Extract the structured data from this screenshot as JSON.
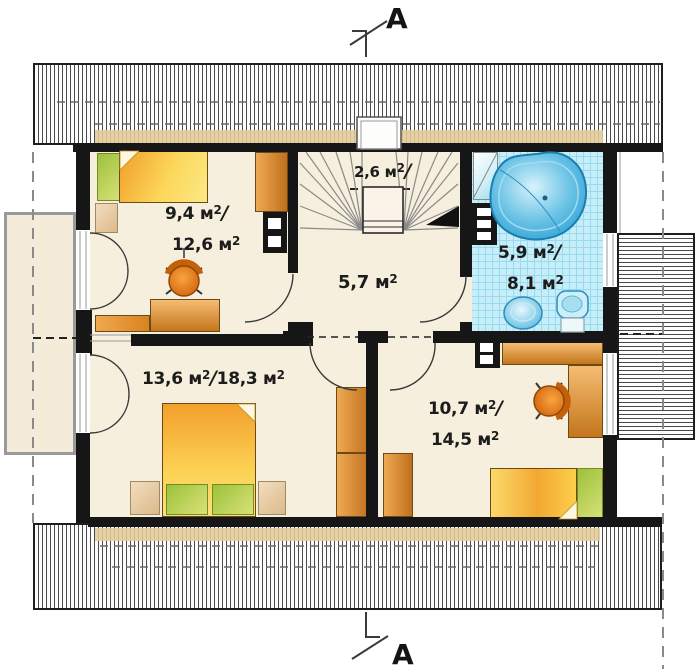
{
  "section": {
    "letter": "A"
  },
  "rooms": {
    "bedroom1": {
      "area1": "9,4 м",
      "sup": "2",
      "slash": "/",
      "area2": "12,6 м"
    },
    "stairs": {
      "area1": "2,6 м",
      "sup": "2",
      "slash": "/"
    },
    "hall": {
      "area1": "5,7 м",
      "sup": "2"
    },
    "bathroom": {
      "area1": "5,9 м",
      "sup": "2",
      "slash": "/",
      "area2": "8,1 м"
    },
    "bedroom2": {
      "area1": "13,6 м",
      "sup": "2",
      "slash": "/",
      "area2": "18,3 м"
    },
    "bedroom3": {
      "area1": "10,7 м",
      "sup": "2",
      "slash": "/",
      "area2": "14,5 м"
    }
  },
  "colors": {
    "wall": "#161616",
    "floor": "#f7efdd",
    "tile_blue": "#c6edf8",
    "water_blue": "#2b9fd4",
    "bed_orange": "#f6a82c",
    "bed_yellow": "#fbd34e",
    "pillow_green": "#bcd24f",
    "furniture_orange": "#e8821e",
    "roof_tan": "#e2cb98"
  }
}
